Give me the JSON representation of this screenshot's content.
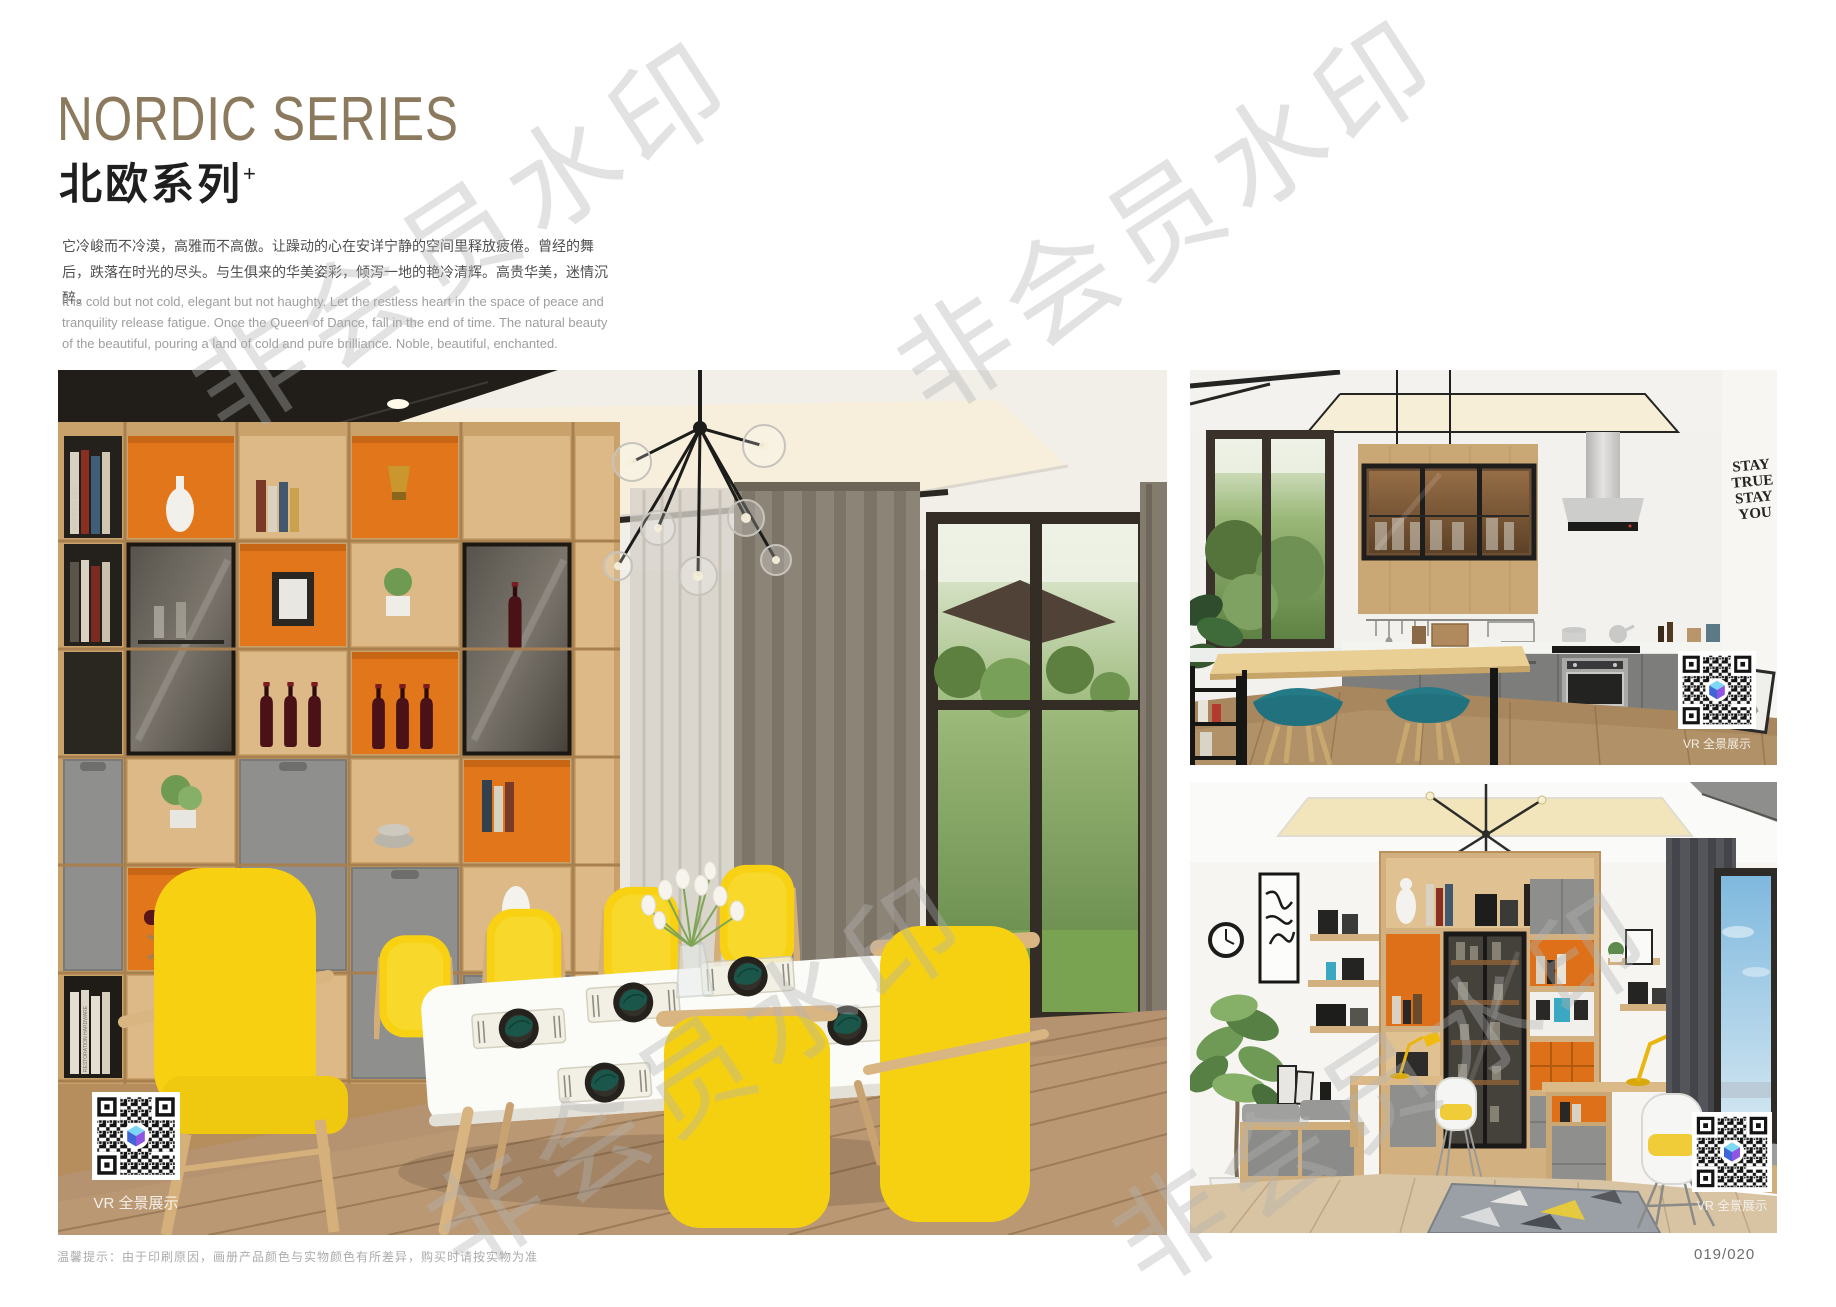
{
  "page": {
    "title_en": "NORDIC SERIES",
    "title_zh": "北欧系列",
    "title_sup": "+",
    "desc_zh": "它冷峻而不冷漠，高雅而不高傲。让躁动的心在安详宁静的空间里释放疲倦。曾经的舞后，跌落在时光的尽头。与生俱来的华美姿彩，倾泻一地的艳冷清辉。高贵华美，迷情沉醉。",
    "desc_en": "It is cold but not cold, elegant but not haughty. Let the restless heart in the space of peace and tranquility release fatigue. Once the Queen of Dance, fall in the end of time. The natural beauty of the beautiful, pouring a land of cold and pure brilliance. Noble, beautiful, enchanted.",
    "footer_tip": "温馨提示：由于印刷原因，画册产品颜色与实物颜色有所差异，购买时请按实物为准",
    "page_number": "019/020",
    "watermark": "非会员水印"
  },
  "images": {
    "dining": {
      "caption": "北欧风格餐厅书柜场景",
      "vr_label": "VR 全景展示",
      "book_spines": [
        "HARPER LEE",
        "C.J REDWINE",
        "RESTORATION HARDWARE"
      ]
    },
    "kitchen": {
      "caption": "北欧风格厨房吧台场景",
      "vr_label": "VR 全景展示",
      "wall_art": [
        "STAY",
        "TRUE",
        "STAY",
        "YOU"
      ]
    },
    "study": {
      "caption": "北欧风格书房场景",
      "vr_label": "VR 全景展示"
    }
  },
  "colors": {
    "title_bronze": "#8c7a5e",
    "accent_orange": "#e1761b",
    "chair_yellow": "#f6d011",
    "wood_light": "#d2b080",
    "cabinet_gray": "#8e8e8c",
    "stool_teal": "#257a88",
    "napkin_teal": "#1a574a"
  }
}
